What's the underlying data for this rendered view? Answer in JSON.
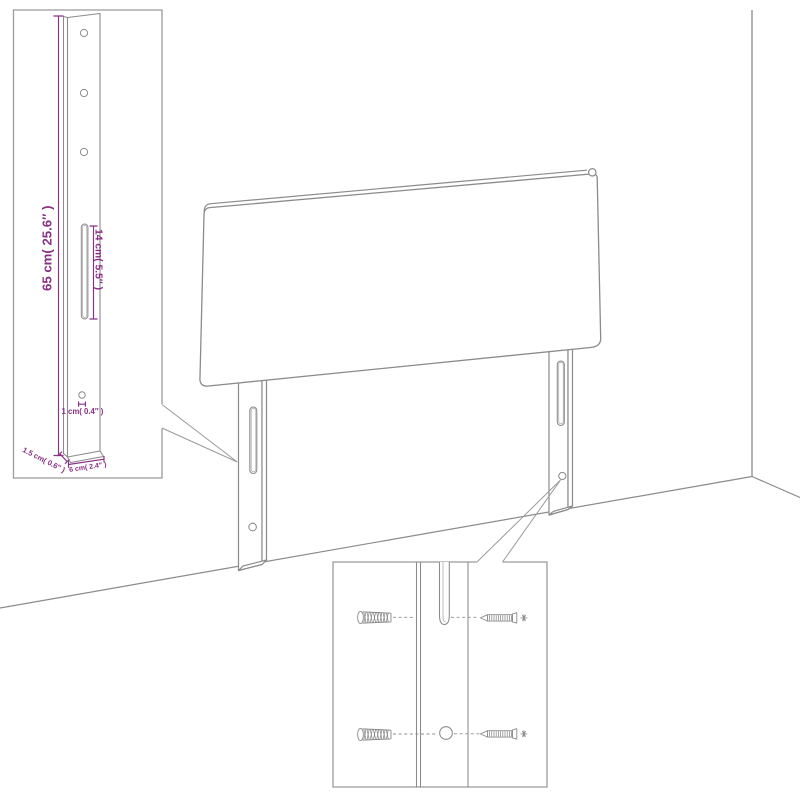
{
  "canvas": {
    "width": 800,
    "height": 800,
    "background": "#ffffff"
  },
  "palette": {
    "outline": "#8b8b8b",
    "inset_border": "#9b9b9b",
    "dimension": "#892f85"
  },
  "leg_detail_inset": {
    "labels": {
      "height": "65 cm( 25.6″ )",
      "slot_length": "14 cm( 5.5″ )",
      "hole_diameter": "1 cm( 0.4″ )",
      "thickness": "1.5 cm( 0.6″ )",
      "width": "6 cm( 2.4″ )"
    }
  }
}
